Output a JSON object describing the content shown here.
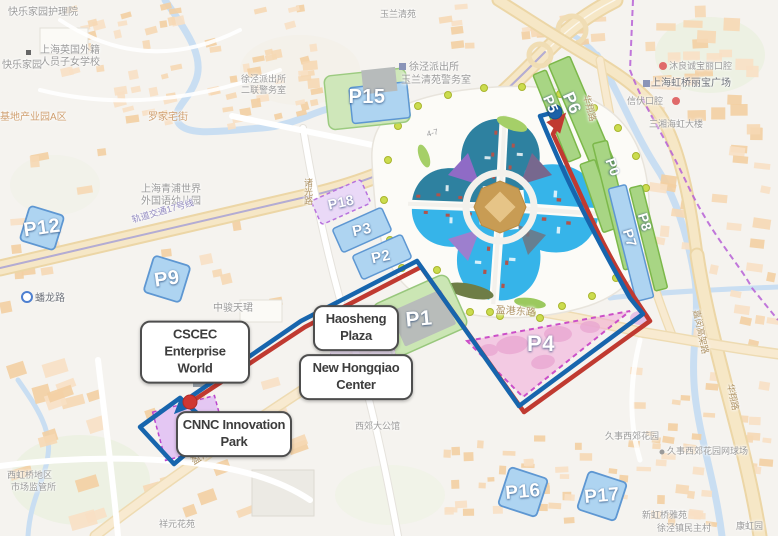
{
  "map": {
    "description": "Shanghai NECC area parking and route map",
    "route": {
      "outbound_color": "#1765ad",
      "return_color": "#c03a31",
      "start_marker_color": "#1b62a8",
      "end_marker_color": "#cf3732"
    },
    "colors": {
      "parking_blue_fill": "#aed4f1",
      "parking_blue_stroke": "#5e97d2",
      "parking_green_fill": "#a8d584",
      "parking_green_stroke": "#7cb84a",
      "parking_purple_fill": "#ead9f7",
      "parking_pink_fill": "#f1afdb",
      "hall_blue": "#36b4e9",
      "hall_teal": "#2e81a0"
    }
  },
  "parking_lots": [
    {
      "id": "p15",
      "label": "P15",
      "kind": "mixed"
    },
    {
      "id": "p5",
      "label": "P5",
      "kind": "green"
    },
    {
      "id": "p6",
      "label": "P6",
      "kind": "green"
    },
    {
      "id": "p0",
      "label": "P0",
      "kind": "green"
    },
    {
      "id": "p8",
      "label": "P8",
      "kind": "green"
    },
    {
      "id": "p7",
      "label": "P7",
      "kind": "blue"
    },
    {
      "id": "p12",
      "label": "P12",
      "kind": "blue"
    },
    {
      "id": "p9",
      "label": "P9",
      "kind": "blue"
    },
    {
      "id": "p18",
      "label": "P18",
      "kind": "purple"
    },
    {
      "id": "p3",
      "label": "P3",
      "kind": "blue"
    },
    {
      "id": "p2",
      "label": "P2",
      "kind": "blue"
    },
    {
      "id": "p1",
      "label": "P1",
      "kind": "green"
    },
    {
      "id": "p4",
      "label": "P4",
      "kind": "pink"
    },
    {
      "id": "p16",
      "label": "P16",
      "kind": "blue"
    },
    {
      "id": "p17",
      "label": "P17",
      "kind": "blue"
    }
  ],
  "place_labels": [
    {
      "id": "cscec",
      "line1": "CSCEC Enterprise",
      "line2": "World"
    },
    {
      "id": "haosheng",
      "line1": "Haosheng",
      "line2": "Plaza"
    },
    {
      "id": "new-hongqiao",
      "line1": "New Hongqiao",
      "line2": "Center"
    },
    {
      "id": "cnnc",
      "line1": "CNNC Innovation",
      "line2": "Park"
    }
  ],
  "map_texts": [
    {
      "text": "快乐家园护理院"
    },
    {
      "text": "快乐家园"
    },
    {
      "text": "上海英国外籍"
    },
    {
      "text": "人员子女学校"
    },
    {
      "text": "玉兰清苑"
    },
    {
      "text": "徐泾派出所"
    },
    {
      "text": "玉兰清苑警务室"
    },
    {
      "text": "徐泾派出所"
    },
    {
      "text": "二联警务室"
    },
    {
      "text": "上海青浦世界"
    },
    {
      "text": "外国语幼儿园"
    },
    {
      "text": "轨道交通17号线"
    },
    {
      "text": "蟠龙路"
    },
    {
      "text": "中骏天珺"
    },
    {
      "text": "诸光路"
    },
    {
      "text": "盈港东路"
    },
    {
      "text": "盈港东路"
    },
    {
      "text": "华翔路"
    },
    {
      "text": "嘉闵高架路"
    },
    {
      "text": "华翔路"
    },
    {
      "text": "罗家宅街"
    },
    {
      "text": "基地产业园A区"
    },
    {
      "text": "沐良诚宝丽口腔"
    },
    {
      "text": "上海虹桥丽宝广场"
    },
    {
      "text": "信伏口腔"
    },
    {
      "text": "三湘海虹大楼"
    },
    {
      "text": "久事西郊花园"
    },
    {
      "text": "久事西郊花园网球场"
    },
    {
      "text": "新虹桥雅苑"
    },
    {
      "text": "徐泾镇民主村"
    },
    {
      "text": "康虹园"
    },
    {
      "text": "西郊大公馆"
    },
    {
      "text": "西虹桥地区"
    },
    {
      "text": "市场监管所"
    },
    {
      "text": "祥元花苑"
    },
    {
      "text": "4-7"
    }
  ]
}
